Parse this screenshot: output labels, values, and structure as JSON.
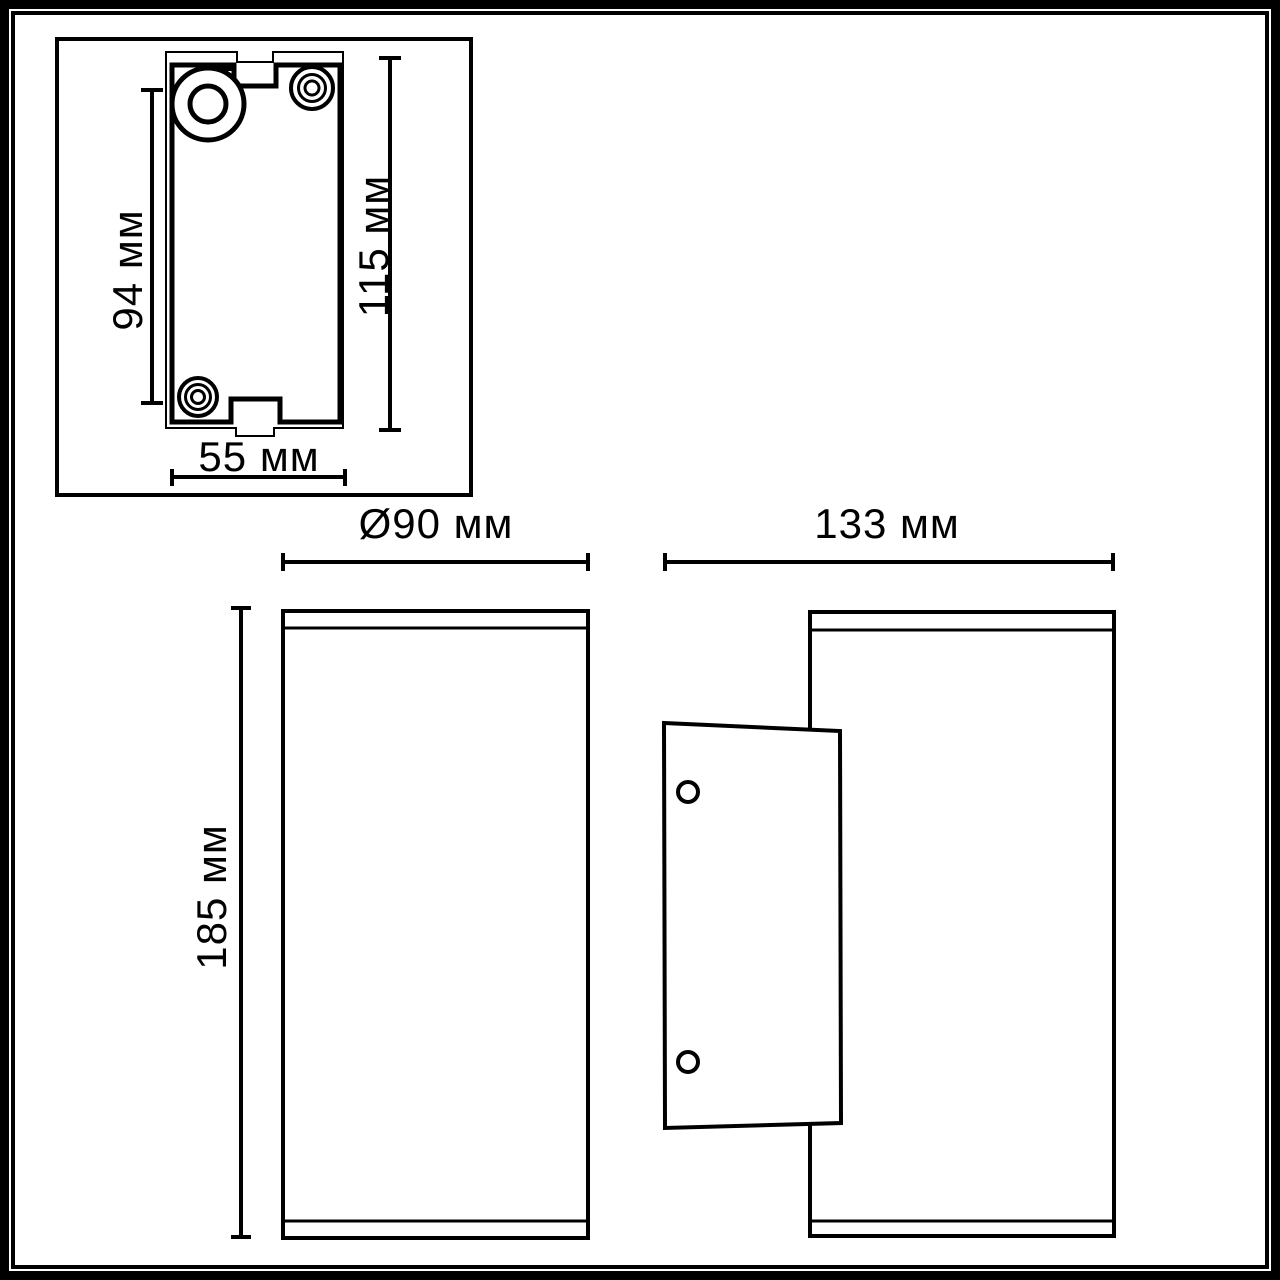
{
  "colors": {
    "line": "#000000",
    "paper": "#ffffff"
  },
  "views": {
    "detail": {
      "dim_inner_height": "94 мм",
      "dim_outer_height": "115 мм",
      "dim_width": "55 мм"
    },
    "front": {
      "dim_diameter": "Ø90 мм",
      "dim_height": "185 мм"
    },
    "side": {
      "dim_depth": "133 мм"
    }
  }
}
